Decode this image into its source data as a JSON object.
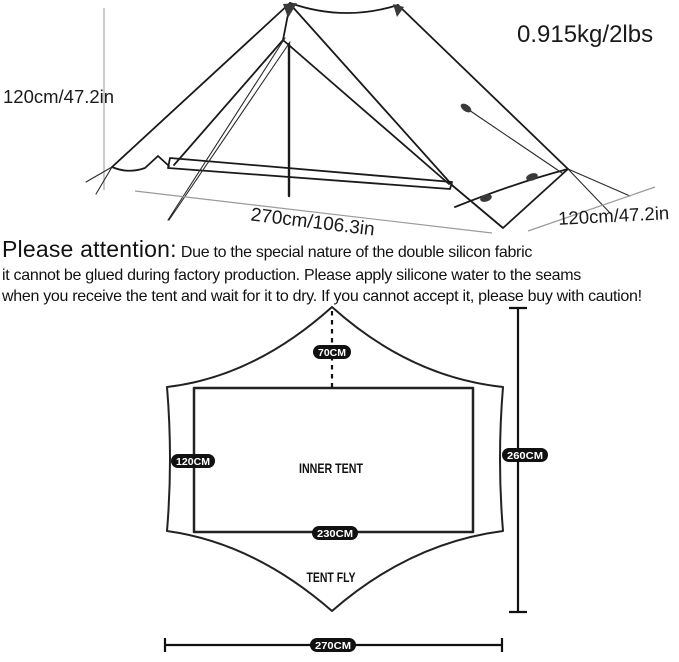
{
  "page": {
    "background": "#ffffff",
    "ink_color": "#1a1a1a",
    "pill_bg": "#111111",
    "pill_text_color": "#ffffff"
  },
  "tent_view": {
    "weight": "0.915kg/2lbs",
    "height": "120cm/47.2in",
    "length": "270cm/106.3in",
    "width": "120cm/47.2in"
  },
  "attention": {
    "heading": "Please attention:",
    "line1": "Due to the special nature of the double silicon fabric",
    "line2": "it cannot be glued during factory production. Please apply silicone water to the seams",
    "line3": "when you receive the tent and wait for it to dry. If you cannot accept it, please buy with caution!"
  },
  "floor_plan": {
    "labels": {
      "inner_tent": "INNER TENT",
      "tent_fly": "TENT FLY"
    },
    "dimensions": {
      "ridge_offset": "70CM",
      "inner_width": "120CM",
      "inner_length": "230CM",
      "fly_length": "260CM",
      "fly_width": "270CM"
    }
  }
}
